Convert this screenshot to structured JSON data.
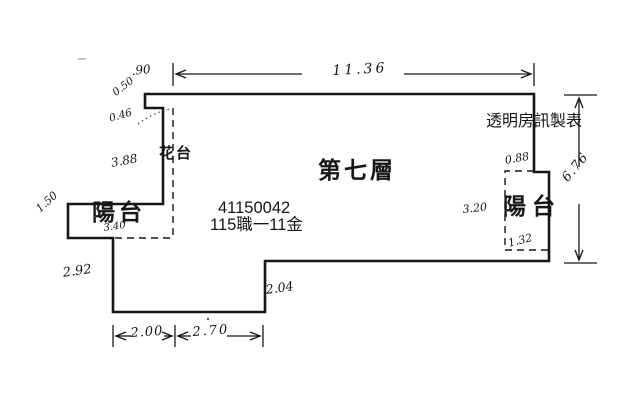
{
  "plan": {
    "floor_title": "第七層",
    "registration_number": "41150042",
    "registration_code": "115職一11金",
    "watermark": "透明房訊製表",
    "room_labels": {
      "balcony_left": "陽台",
      "balcony_right": "陽台",
      "flower_box": "花台"
    },
    "dimensions": {
      "top_width": "11.36",
      "top_left_offset": ".90",
      "step_height": "0.50",
      "step_width": "0.46",
      "left_wall_length": "3.88",
      "balcony_left_width": "3.40",
      "balcony_left_depth": "1.50",
      "lower_left_wall": "2.92",
      "bottom_segment_1": "2.00",
      "bottom_segment_2": "2.70",
      "bottom_step_height": "2.04",
      "right_side_height": "6.76",
      "balcony_right_top_width": "0.88",
      "balcony_right_height": "3.20",
      "balcony_right_bottom_width": "1.32"
    },
    "colors": {
      "ink": "#161616",
      "background": "#ffffff"
    }
  }
}
